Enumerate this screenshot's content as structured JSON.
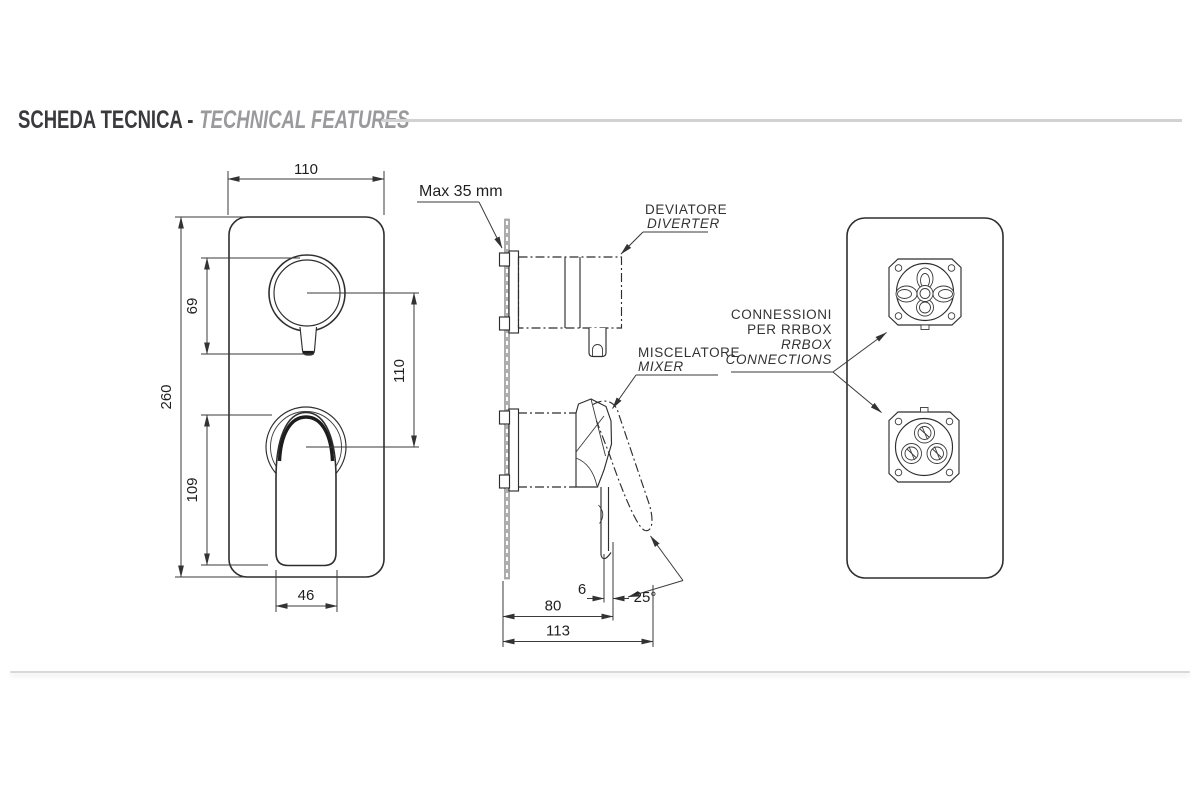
{
  "header": {
    "title_primary": "SCHEDA TECNICA -",
    "title_secondary": "TECHNICAL FEATURES"
  },
  "front_view": {
    "dim_width": "110",
    "dim_height": "260",
    "dim_knob_height": "69",
    "dim_center_distance": "110",
    "dim_lever_height": "109",
    "dim_lever_width": "46"
  },
  "side_view": {
    "wall_note": "Max 35 mm",
    "diverter_label_it": "DEVIATORE",
    "diverter_label_en": "DIVERTER",
    "mixer_label_it": "MISCELATORE",
    "mixer_label_en": "MIXER",
    "dim_offset": "6",
    "dim_angle": "25°",
    "dim_depth_body": "80",
    "dim_depth_total": "113"
  },
  "back_view": {
    "connections_it_1": "CONNESSIONI",
    "connections_it_2": "PER RRBOX",
    "connections_en_1": "RRBOX",
    "connections_en_2": "CONNECTIONS"
  },
  "colors": {
    "line": "#2e2e2e",
    "title_primary": "#3a3a3c",
    "title_secondary": "#9a9a9c",
    "rule": "#d2d2d2"
  }
}
